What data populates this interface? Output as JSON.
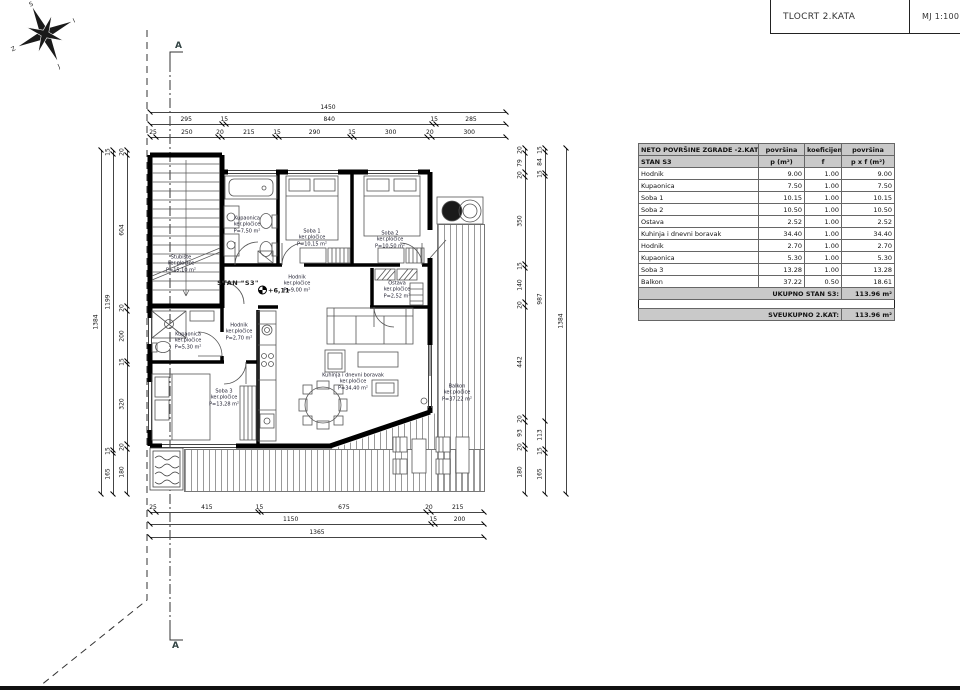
{
  "title_block": {
    "title": "TLOCRT 2.KATA",
    "scale": "MJ 1:100"
  },
  "compass": {
    "n": "S",
    "e": "I",
    "s": "J",
    "w": "Z"
  },
  "axis": {
    "label": "A"
  },
  "apartment_label": "STAN \"S3\"",
  "elevation": "+6,11",
  "rooms": [
    {
      "name": "Stubište",
      "material": "ker.pločice",
      "area": "P=15,10 m²"
    },
    {
      "name": "Kupaonica",
      "material": "ker.pločice",
      "area": "P=7,50 m²"
    },
    {
      "name": "Soba 1",
      "material": "ker.pločice",
      "area": "P=10,15 m²"
    },
    {
      "name": "Soba 2",
      "material": "ker.pločice",
      "area": "P=10,50 m²"
    },
    {
      "name": "Hodnik",
      "material": "ker.pločice",
      "area": "P=9,00 m²"
    },
    {
      "name": "Ostava",
      "material": "ker.pločice",
      "area": "P=2,52 m²"
    },
    {
      "name": "Kupaonica",
      "material": "ker.pločice",
      "area": "P=5,30 m²"
    },
    {
      "name": "Hodnik",
      "material": "ker.pločice",
      "area": "P=2,70 m²"
    },
    {
      "name": "Soba 3",
      "material": "ker.pločice",
      "area": "P=13,28 m²"
    },
    {
      "name": "Kuhinja i dnevni boravak",
      "material": "ker.pločice",
      "area": "P=34,40 m²"
    },
    {
      "name": "Balkon",
      "material": "ker.pločice",
      "area": "P=37,22 m²"
    }
  ],
  "dimensions": {
    "top": {
      "rows": [
        [
          "1450"
        ],
        [
          "295",
          "15",
          "840",
          "15",
          "285"
        ],
        [
          "25",
          "250",
          "20",
          "215",
          "15",
          "290",
          "15",
          "300",
          "20",
          "300"
        ]
      ]
    },
    "bottom": {
      "rows": [
        [
          "25",
          "415",
          "15",
          "675",
          "20",
          "215"
        ],
        [
          "1150",
          "15",
          "200"
        ],
        [
          "1365"
        ]
      ]
    },
    "left": {
      "rows": [
        [
          "1384"
        ],
        [
          "15",
          "1199",
          "15",
          "165"
        ],
        [
          "20",
          "604",
          "20",
          "200",
          "15",
          "320",
          "20",
          "180"
        ]
      ]
    },
    "right": {
      "rows": [
        [
          "20",
          "79",
          "20",
          "350",
          "15",
          "140",
          "20",
          "442",
          "20",
          "93",
          "20",
          "180"
        ],
        [
          "15",
          "84",
          "15",
          "987",
          "113",
          "15",
          "165"
        ],
        [
          "1384"
        ]
      ]
    }
  },
  "table": {
    "header_bg": "#c9c9c9",
    "header_title": "NETO POVRŠINE ZGRADE -2.KAT",
    "header_cols": [
      "površina",
      "koeficijent",
      "površina"
    ],
    "subheader": [
      "STAN S3",
      "p (m²)",
      "f",
      "p x f (m²)"
    ],
    "rows": [
      [
        "Hodnik",
        "9.00",
        "1.00",
        "9.00"
      ],
      [
        "Kupaonica",
        "7.50",
        "1.00",
        "7.50"
      ],
      [
        "Soba 1",
        "10.15",
        "1.00",
        "10.15"
      ],
      [
        "Soba 2",
        "10.50",
        "1.00",
        "10.50"
      ],
      [
        "Ostava",
        "2.52",
        "1.00",
        "2.52"
      ],
      [
        "Kuhinja i dnevni boravak",
        "34.40",
        "1.00",
        "34.40"
      ],
      [
        "Hodnik",
        "2.70",
        "1.00",
        "2.70"
      ],
      [
        "Kupaonica",
        "5.30",
        "1.00",
        "5.30"
      ],
      [
        "Soba 3",
        "13.28",
        "1.00",
        "13.28"
      ],
      [
        "Balkon",
        "37.22",
        "0.50",
        "18.61"
      ]
    ],
    "total_label": "UKUPNO STAN S3:",
    "total_value": "113.96 m²",
    "grand_label": "SVEUKUPNO 2.KAT:",
    "grand_value": "113.96 m²"
  }
}
